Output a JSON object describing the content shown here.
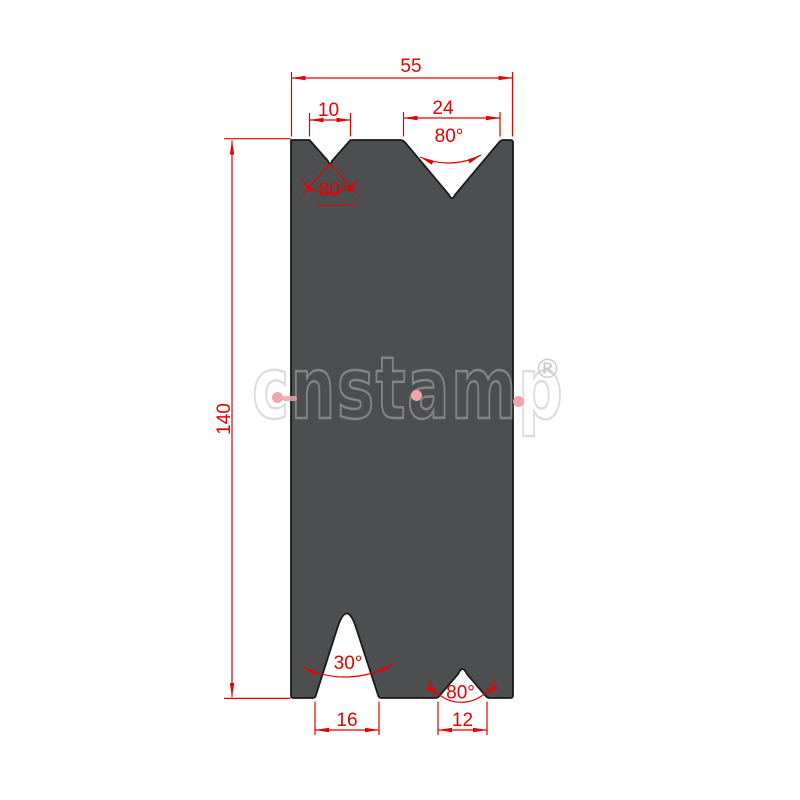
{
  "labels": {
    "top_width": "55",
    "top_left_v_width": "10",
    "top_left_v_angle": "80°",
    "top_right_v_width": "24",
    "top_right_v_angle": "80°",
    "overall_height": "140",
    "bottom_left_v_angle": "30°",
    "bottom_left_v_width": "16",
    "bottom_right_v_angle": "80°",
    "bottom_right_v_width": "12"
  },
  "watermark": {
    "brand": "cnstamp",
    "registered": "®"
  },
  "colors": {
    "die_fill": "#4d4e50",
    "outline": "#1a1a1a",
    "dimension_red": "#e60000",
    "watermark_gray": "#b9b9b9",
    "watermark_dot_pink": "#f2a4aa"
  }
}
